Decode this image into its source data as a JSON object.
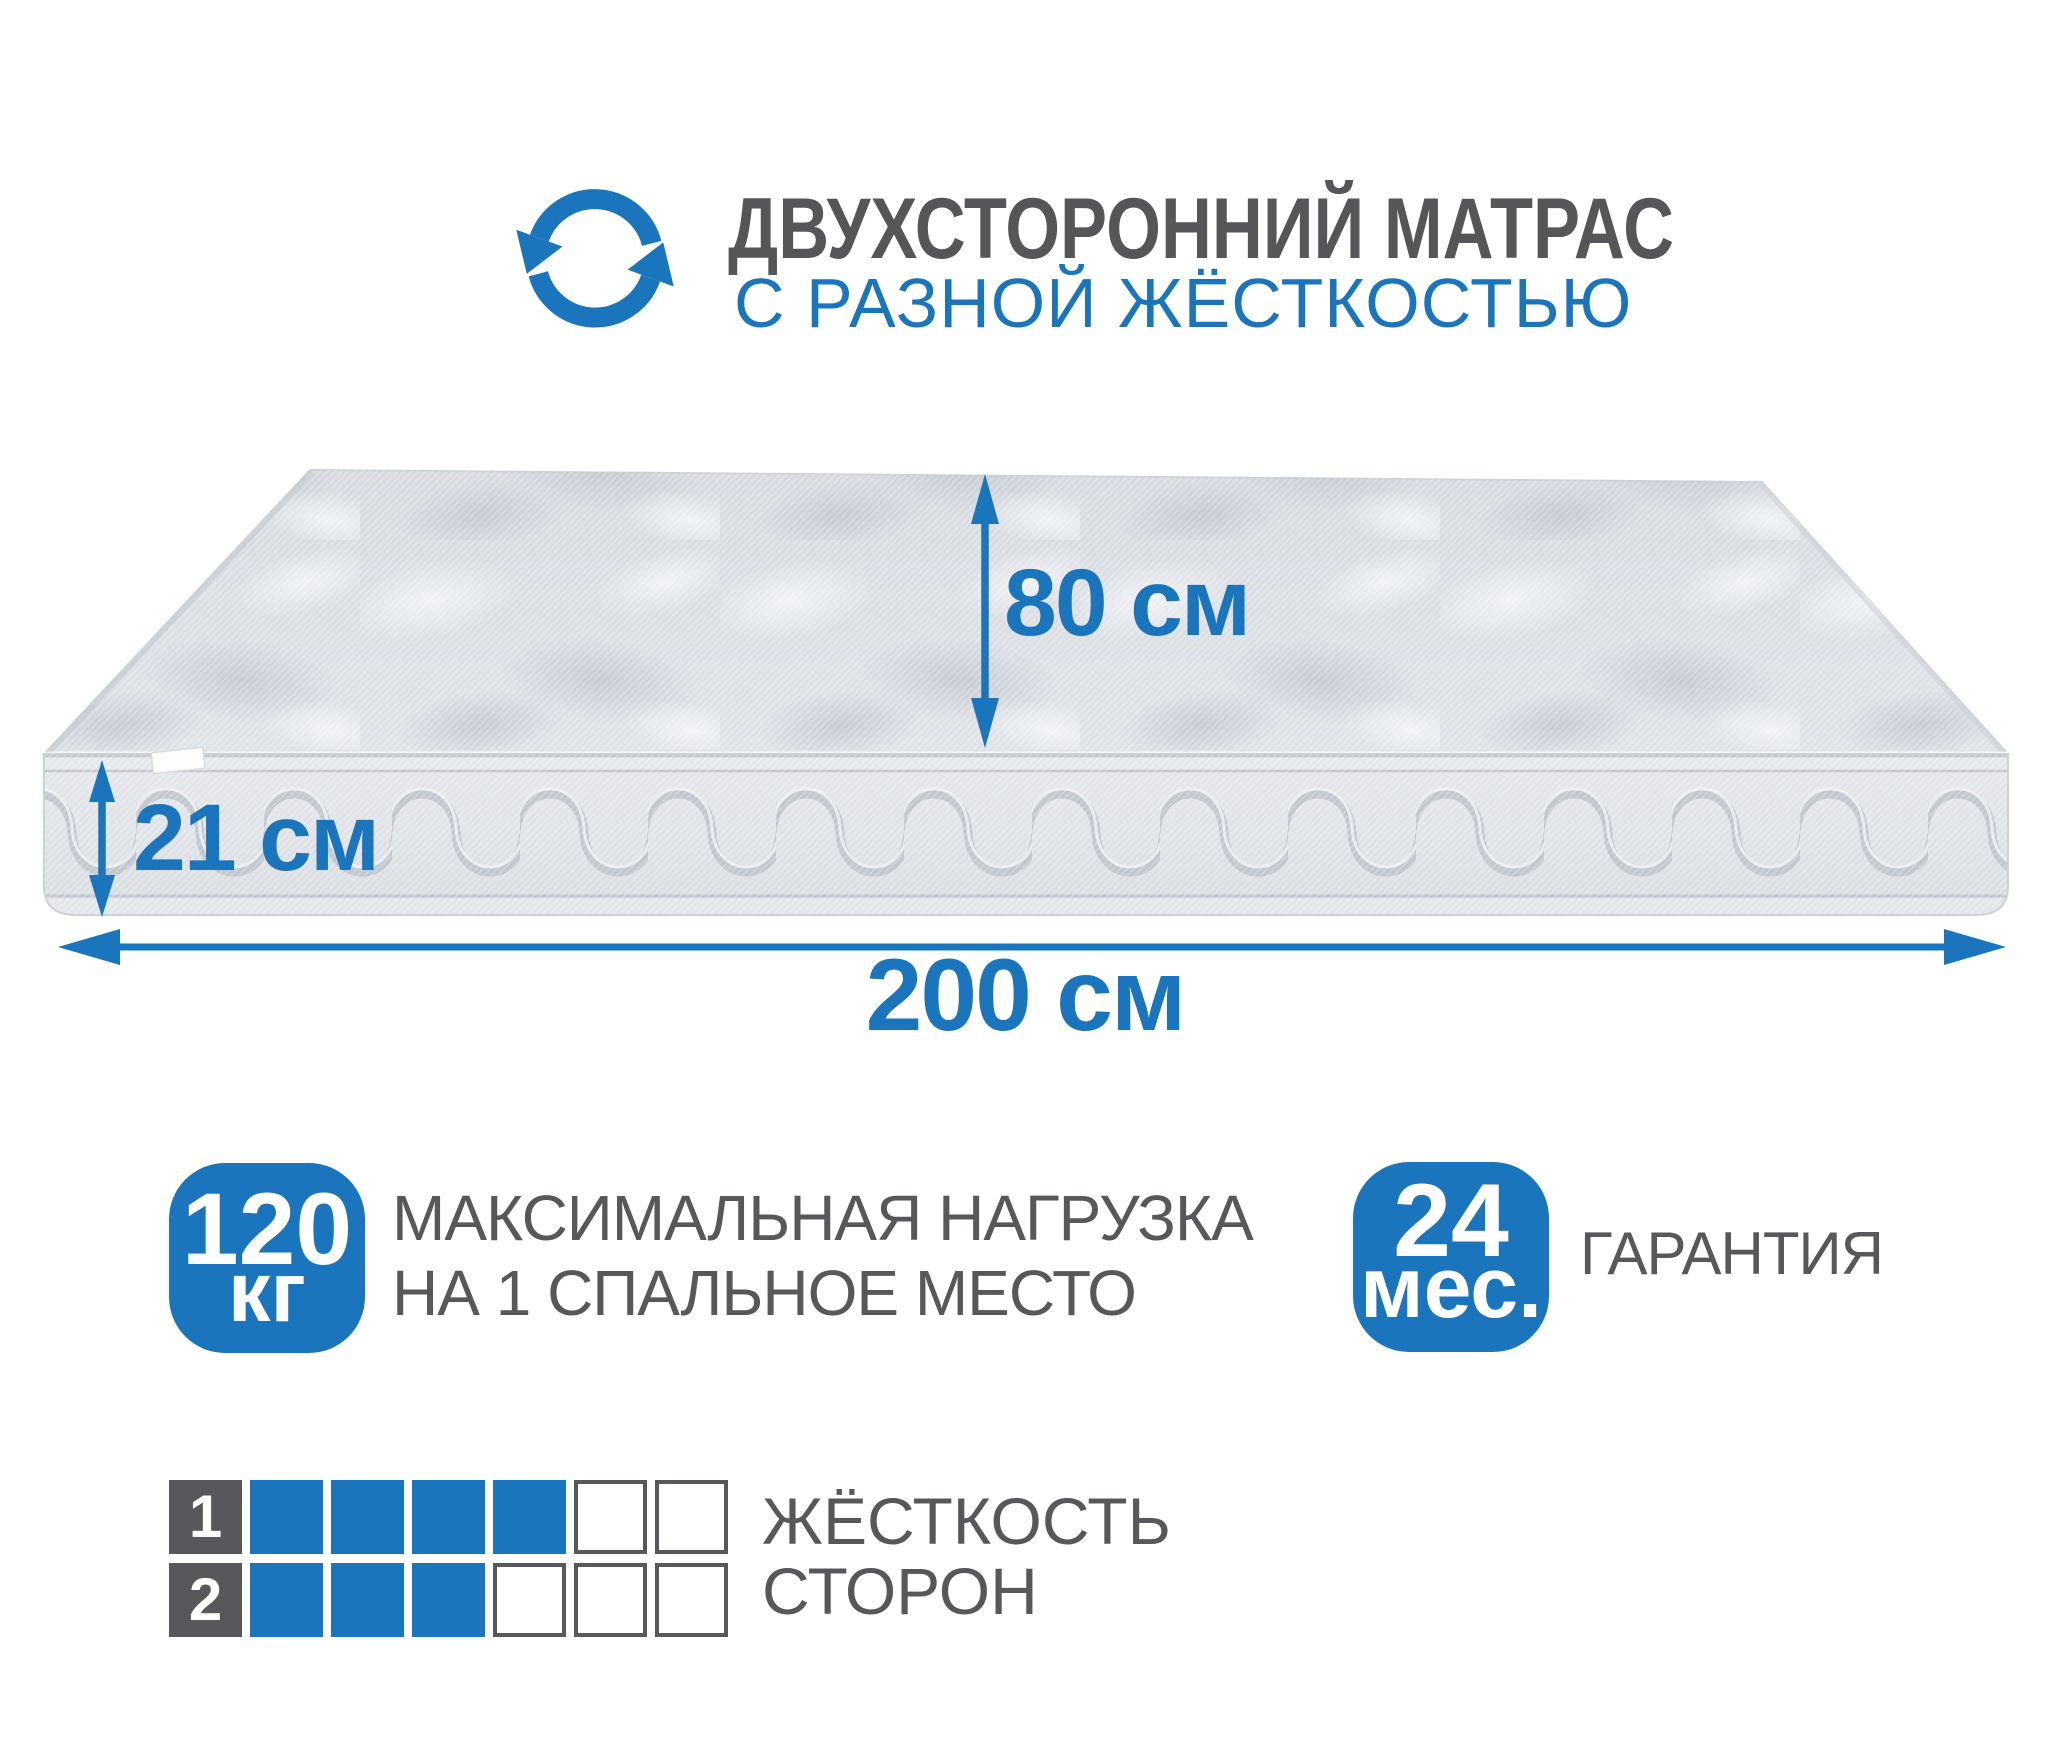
{
  "colors": {
    "accent": "#1b75bc",
    "text_gray": "#57585a",
    "tile_gray": "#57585b"
  },
  "header": {
    "icon": "rotate-arrows-icon",
    "title": "ДВУХСТОРОННИЙ МАТРАС",
    "subtitle": "С РАЗНОЙ ЖЁСТКОСТЬЮ"
  },
  "diagram": {
    "depth_label": "80 см",
    "thickness_label": "21 см",
    "length_label": "200 см"
  },
  "badges": {
    "max_load": {
      "value": "120",
      "unit": "кг",
      "line1": "МАКСИМАЛЬНАЯ НАГРУЗКА",
      "line2": "НА 1 СПАЛЬНОЕ МЕСТО"
    },
    "warranty": {
      "value": "24",
      "unit": "мес.",
      "label": "ГАРАНТИЯ"
    }
  },
  "firmness": {
    "title_line1": "ЖЁСТКОСТЬ",
    "title_line2": "СТОРОН",
    "scale_max": 6,
    "rows": [
      {
        "number": "1",
        "filled": 4,
        "total": 6
      },
      {
        "number": "2",
        "filled": 3,
        "total": 6
      }
    ]
  }
}
